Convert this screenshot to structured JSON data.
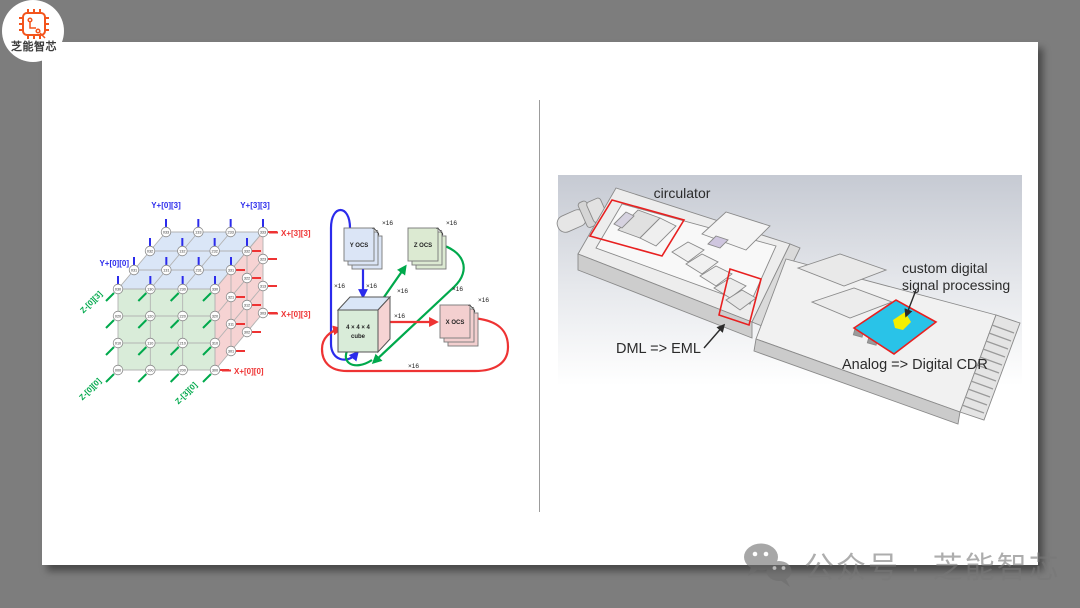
{
  "page": {
    "background_color": "#7d7d7d",
    "slide_color": "#ffffff"
  },
  "logo": {
    "brand_text": "芝能智芯",
    "icon": "chip-icon",
    "accent_color": "#f3541c"
  },
  "watermark": {
    "icon": "wechat-icon",
    "text": "公众号 · 芝能智芯"
  },
  "colors": {
    "blue": "#2b2bec",
    "green": "#00a94c",
    "red": "#ee3333",
    "face_top": "#dae6f7",
    "face_front": "#d9ecd9",
    "face_right": "#f6d3d3",
    "edge_gray": "#b3b3b3",
    "highlight_red": "#e82020",
    "chip_cyan": "#29c3e8",
    "chip_yellow": "#f5ef00"
  },
  "left_figure": {
    "type": "3d-torus-lattice",
    "axis_labels": [
      {
        "text": "Y+[0][3]",
        "color": "blue"
      },
      {
        "text": "Y+[3][3]",
        "color": "blue"
      },
      {
        "text": "Y+[0][0]",
        "color": "blue"
      },
      {
        "text": "X+[3][3]",
        "color": "red"
      },
      {
        "text": "X+[0][3]",
        "color": "red"
      },
      {
        "text": "X+[0][0]",
        "color": "red"
      },
      {
        "text": "Z-[0][3]",
        "color": "green"
      },
      {
        "text": "Z-[0][0]",
        "color": "green"
      },
      {
        "text": "Z-[3][0]",
        "color": "green"
      }
    ],
    "top_face_nodes": [
      [
        "033",
        "133",
        "233",
        "333"
      ],
      [
        "032",
        "132",
        "232",
        "332"
      ],
      [
        "031",
        "131",
        "231",
        "331"
      ],
      [
        "030",
        "130",
        "230",
        "330"
      ]
    ],
    "front_face_nodes": [
      [
        "030",
        "130",
        "230",
        "330"
      ],
      [
        "020",
        "120",
        "220",
        "320"
      ],
      [
        "010",
        "110",
        "210",
        "310"
      ],
      [
        "000",
        "100",
        "200",
        "300"
      ]
    ],
    "right_face_nodes": [
      [
        "321",
        "311",
        "301"
      ],
      [
        "322",
        "312",
        "302"
      ],
      [
        "323",
        "313",
        "303"
      ]
    ]
  },
  "middle_figure": {
    "switches": [
      {
        "label": "Y OCS",
        "count_label": "×16",
        "fill": "#dbe5f6"
      },
      {
        "label": "Z OCS",
        "count_label": "×16",
        "fill": "#dcead2"
      },
      {
        "label": "X OCS",
        "count_label": "×16",
        "fill": "#f3cfcf"
      }
    ],
    "cube_label_line1": "4 × 4 × 4",
    "cube_label_line2": "cube",
    "link_count_label": "×16"
  },
  "right_figure": {
    "type": "optical-module-cad",
    "labels": {
      "circulator": "circulator",
      "custom_dsp_line1": "custom digital",
      "custom_dsp_line2": "signal processing",
      "dml": "DML => EML",
      "cdr": "Analog => Digital CDR"
    }
  }
}
